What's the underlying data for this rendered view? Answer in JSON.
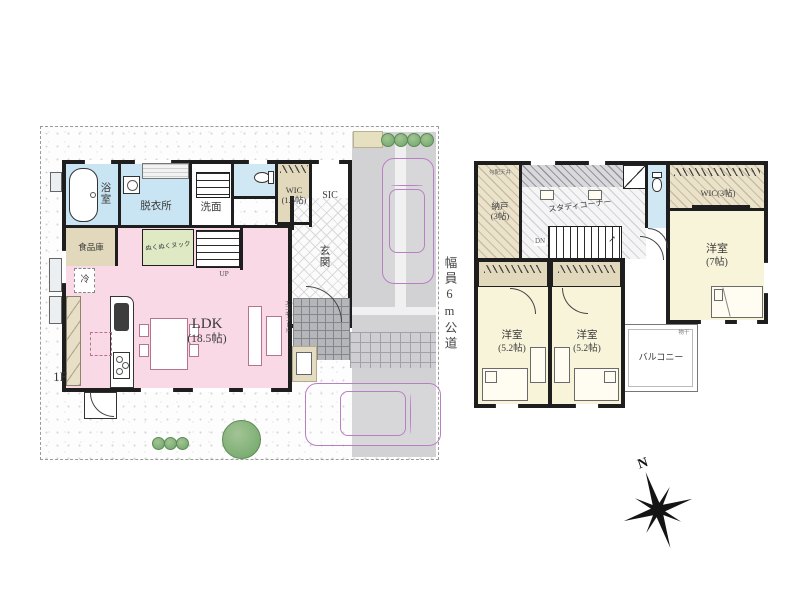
{
  "floor1": {
    "floor_label": "1F",
    "bathroom": "浴室",
    "dressing_room": "脱衣所",
    "washroom": "洗面",
    "wic_label": "WIC",
    "wic_size": "(1.5帖)",
    "sic_label": "SIC",
    "entrance": "玄関",
    "pantry": "食品庫",
    "nook": "ぬくぬくヌック",
    "fridge": "冷",
    "ldk_label": "LDK",
    "ldk_size": "(18.5帖)",
    "stairs_up": "UP",
    "water_heater": "エコキュート"
  },
  "road": {
    "label": "幅員6m公道"
  },
  "floor2": {
    "sloped_ceiling": "勾配天井",
    "storeroom": "納戸",
    "storeroom_size": "(3帖)",
    "study_corner": "スタディコーナー",
    "stairs_down": "DN",
    "stairs_arrow": "↗",
    "wic_label": "WIC(3帖)",
    "bedroom_main": "洋室",
    "bedroom_main_size": "(7帖)",
    "bedroom_left": "洋室",
    "bedroom_left_size": "(5.2帖)",
    "bedroom_right": "洋室",
    "bedroom_right_size": "(5.2帖)",
    "balcony": "バルコニー",
    "drying_pole": "物干"
  },
  "compass": {
    "north_label": "N"
  },
  "colors": {
    "ldk_pink": "#f9d9e6",
    "wet_area_blue": "#c9e5f3",
    "nook_green": "#dfe9c4",
    "storage_beige": "#e2d8bb",
    "bedroom_cream": "#f8f4da",
    "car_outline": "#b97fc4",
    "tree_green": "#7cae74",
    "driveway_gray": "#d2d2d5",
    "wall_black": "#1e1e1e"
  }
}
